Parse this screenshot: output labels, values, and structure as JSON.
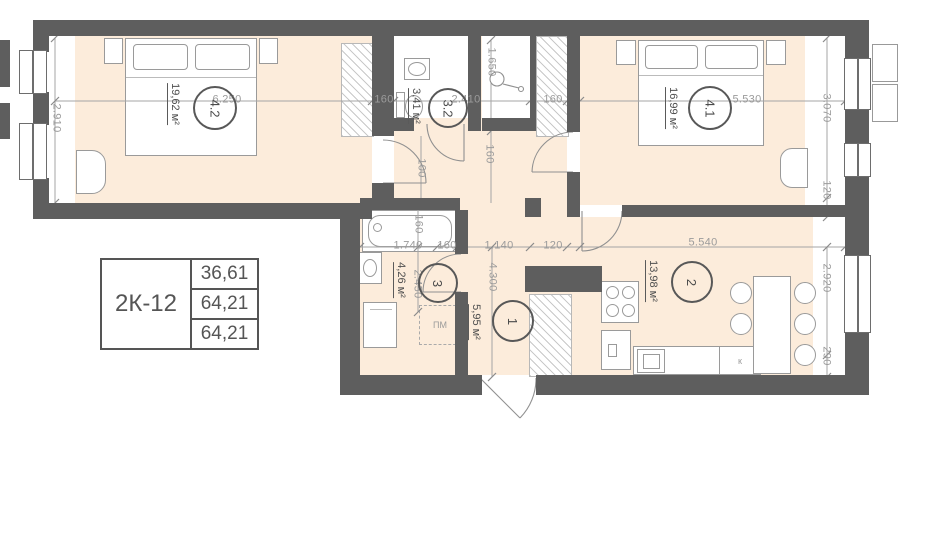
{
  "info_table": {
    "unit": "2К-12",
    "values": [
      "36,61",
      "64,21",
      "64,21"
    ]
  },
  "rooms": {
    "r42": {
      "number": "4.2",
      "area": "19,62 м²"
    },
    "r41": {
      "number": "4.1",
      "area": "16,99 м²"
    },
    "r32": {
      "number": "3.2",
      "area": "3,41 м²"
    },
    "r3": {
      "number": "3",
      "area": "4,26 м²"
    },
    "r1": {
      "number": "1",
      "area": "5,95 м²"
    },
    "r2": {
      "number": "2",
      "area": "13,98 м²"
    }
  },
  "dims": {
    "room42_width": "6.250",
    "wall_top_left": "160",
    "room32_width": "2.410",
    "wall_top_right": "160",
    "room41_width": "5.530",
    "room42_height": "2.910",
    "room32_depth": "1.650",
    "hall_100": "100",
    "hall_160": "160",
    "bath_width": "1.740",
    "bath_wall": "160",
    "hall_width": "1.140",
    "kitchen_wall": "120",
    "kitchen_width": "5.540",
    "bath_160": "160",
    "bath_height": "2.450",
    "hall_height": "4.300",
    "room41_height": "3.070",
    "room41_120": "120",
    "kitchen_height": "2.920",
    "kitchen_290": "290"
  },
  "labels": {
    "washing_machine": "ПМ",
    "kitchen_sink": "к"
  },
  "colors": {
    "wall": "#5e5e5e",
    "floor": "#fcecdb",
    "dim_text": "#9b9b9b",
    "dark_text": "#4f4f4f"
  }
}
